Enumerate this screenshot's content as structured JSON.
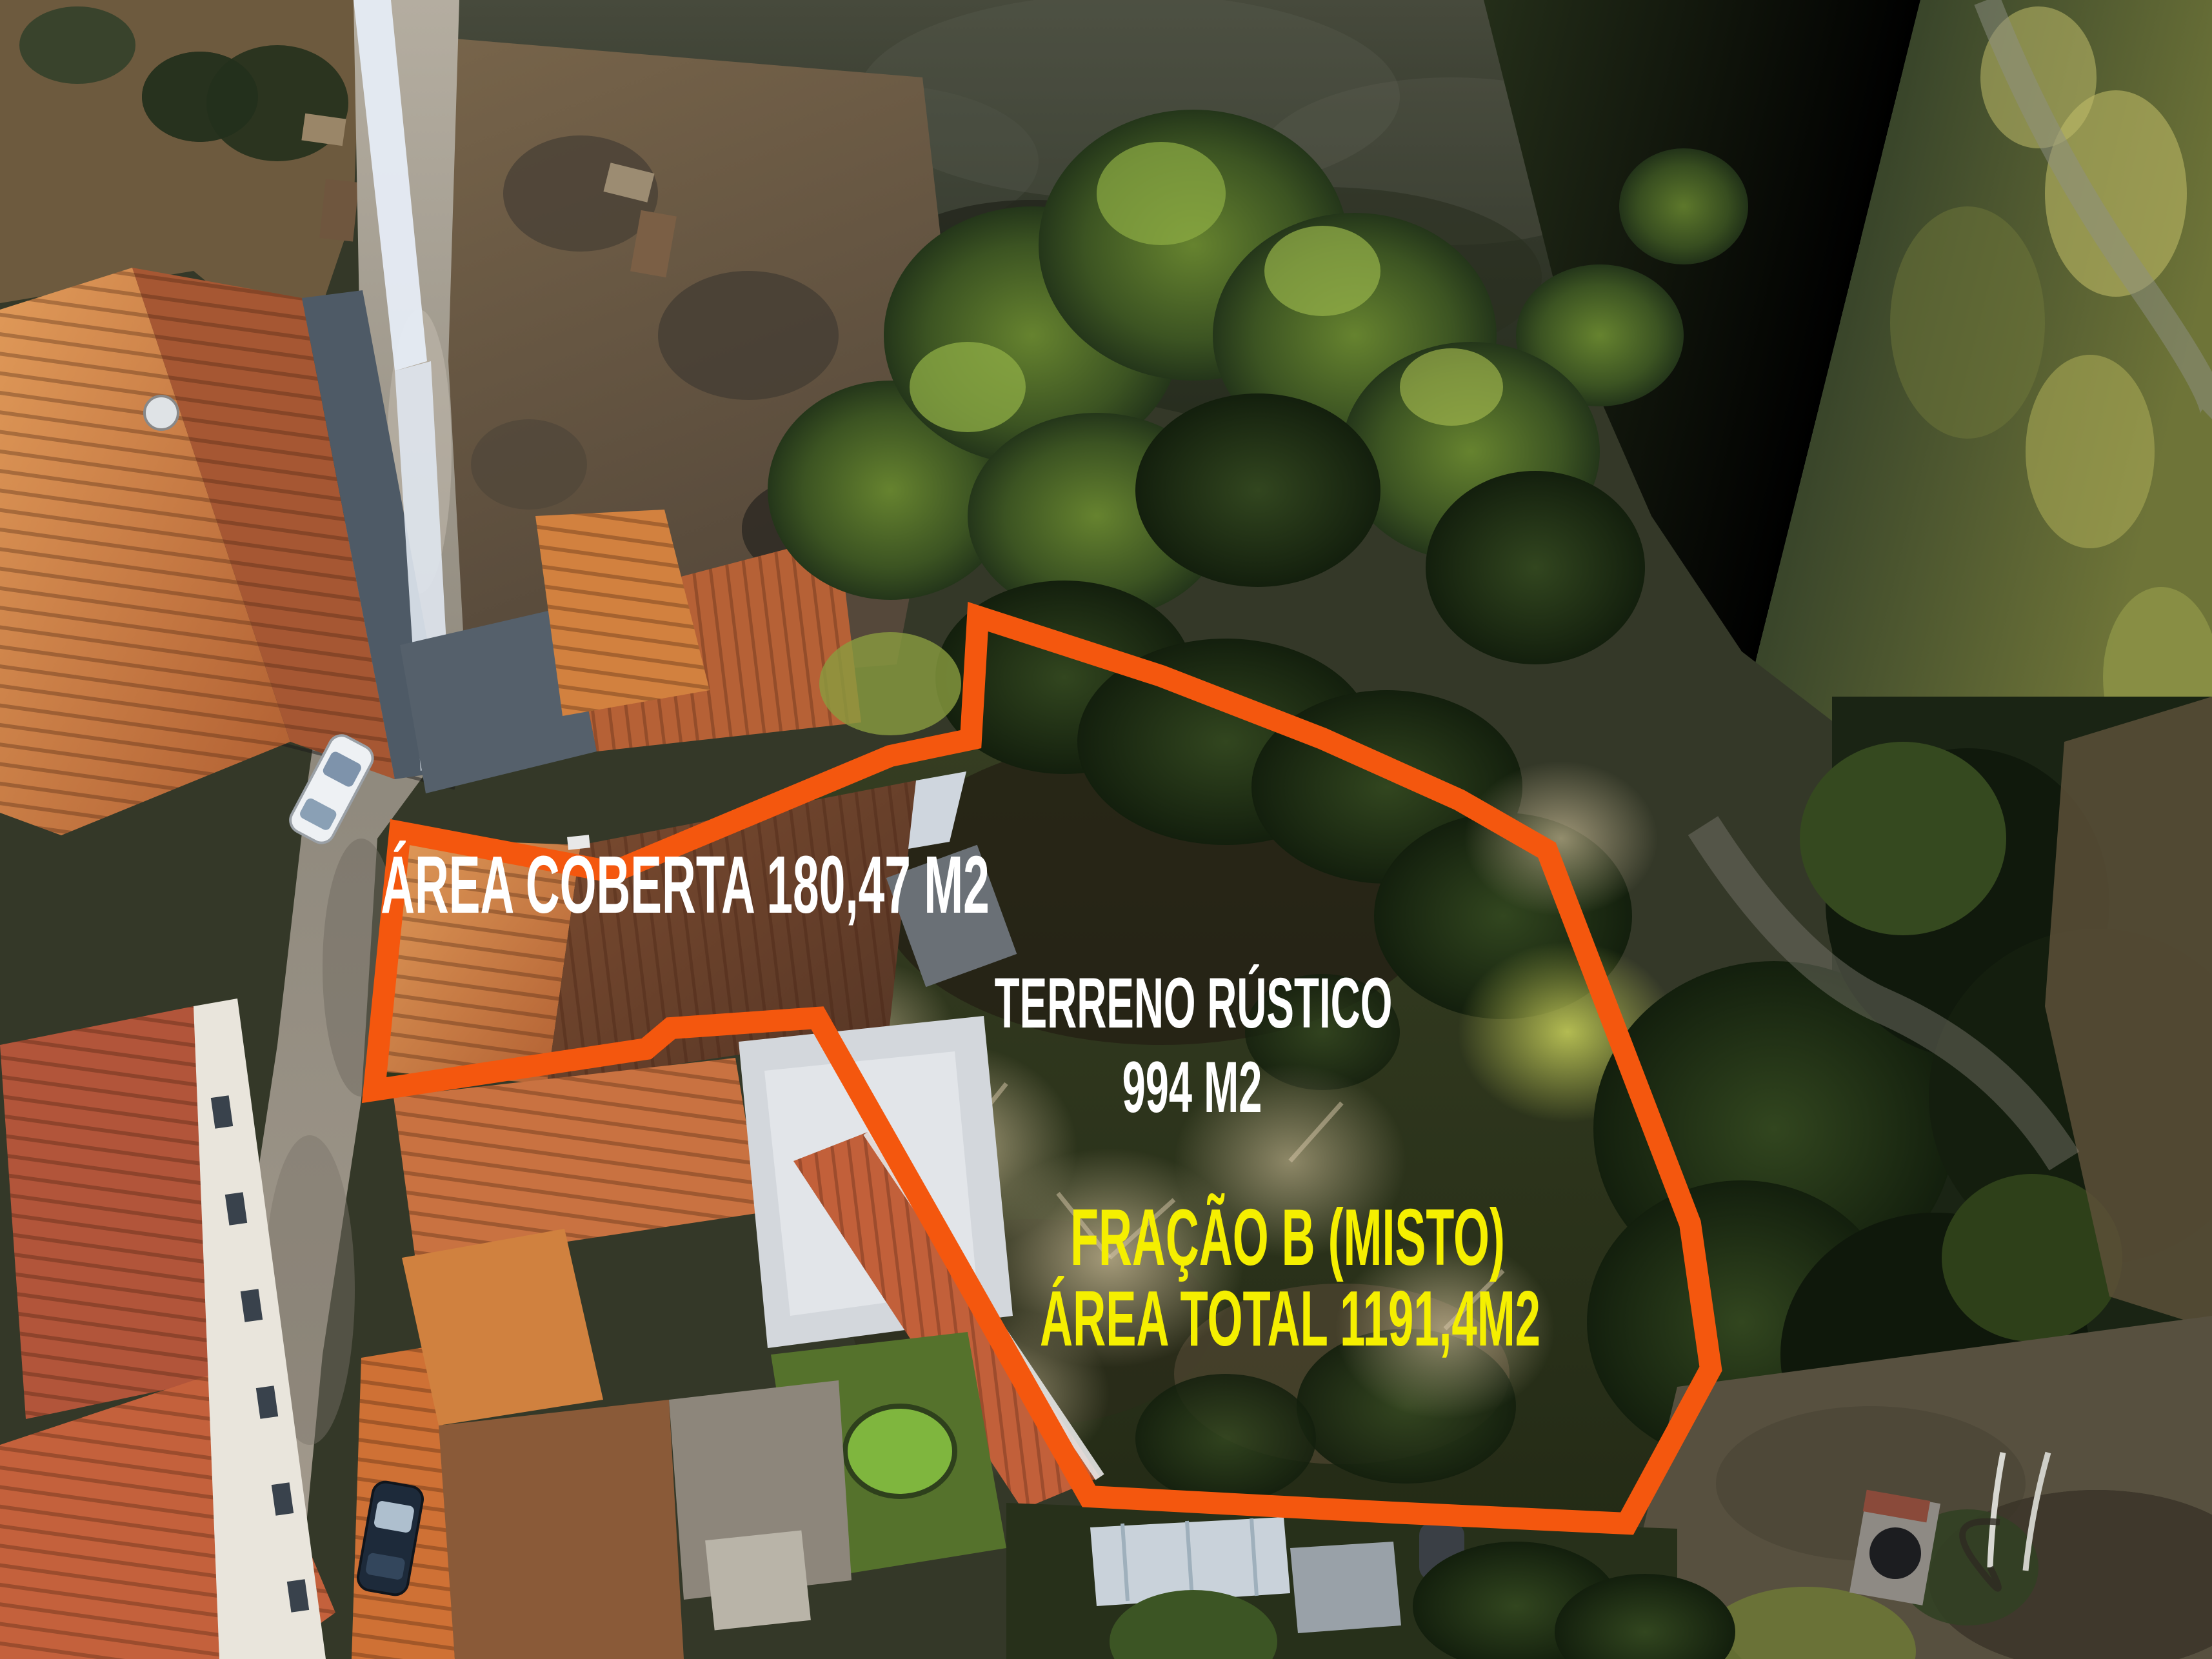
{
  "labels": {
    "area_coberta": "ÁREA COBERTA 180,47 M2",
    "terreno_rustico_line1": "TERRENO RÚSTICO",
    "terreno_rustico_line2": "994 M2",
    "fracao_line1": "FRAÇÃO B (MISTO)",
    "fracao_line2": "ÁREA TOTAL 1191,4M2"
  },
  "colors": {
    "boundary_orange": "#F4570E",
    "label_white": "#FFFFFF",
    "label_yellow": "#F5EF00"
  }
}
